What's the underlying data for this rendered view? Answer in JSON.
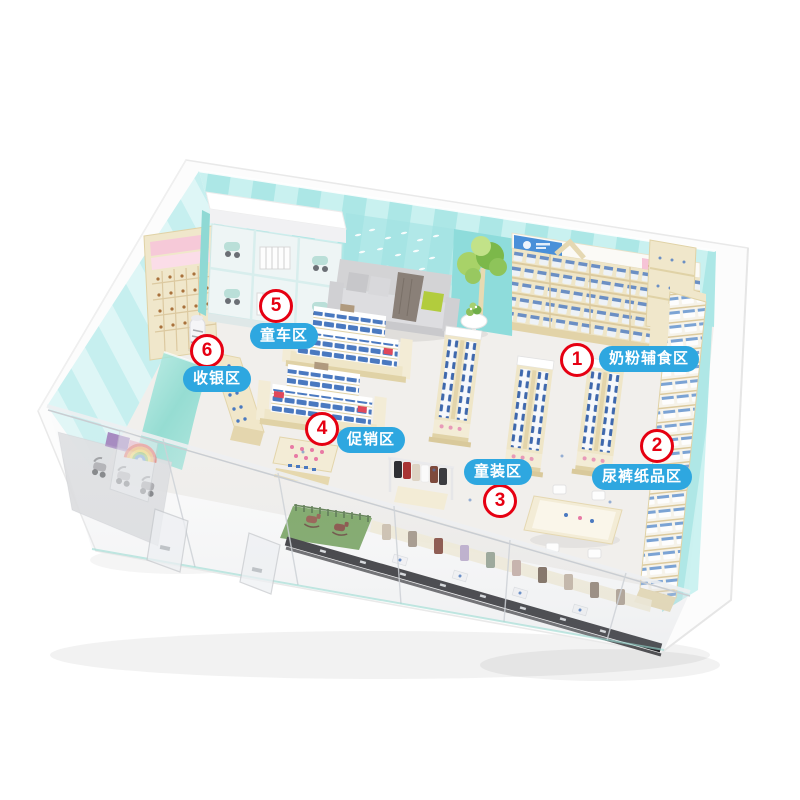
{
  "zones": [
    {
      "number": "1",
      "label": "奶粉辅食区"
    },
    {
      "number": "2",
      "label": "尿裤纸品区"
    },
    {
      "number": "3",
      "label": "童装区"
    },
    {
      "number": "4",
      "label": "促销区"
    },
    {
      "number": "5",
      "label": "童车区"
    },
    {
      "number": "6",
      "label": "收银区"
    }
  ],
  "style": {
    "zone_pill_bg": "#2EA7E0",
    "zone_pill_text": "#FFFFFF",
    "zone_badge_bg": "#FFFFFF",
    "zone_badge_border": "#E60012",
    "zone_badge_text": "#E60012",
    "wall_teal": "#ACE7E6",
    "wall_teal_light": "#C9F1F0",
    "shelf_cream": "#EFE6C8",
    "floor": "#F1EFEC",
    "sofa_gray": "#D8D8DA",
    "tree_green": "#8BC34A",
    "product_blue": "#3E68AD",
    "glass_gray": "#CDD1D6",
    "cashier_mint": "#7FD8CC"
  }
}
